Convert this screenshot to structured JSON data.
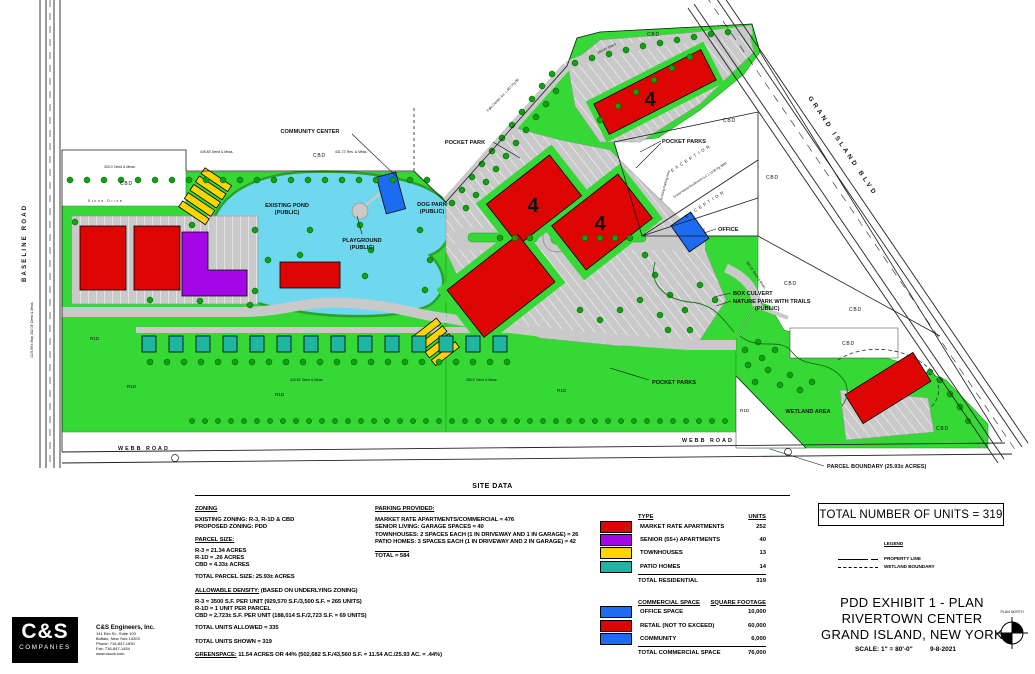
{
  "map": {
    "roads": {
      "baseline": "BASELINE ROAD",
      "webb": "WEBB ROAD",
      "grand_island": "GRAND ISLAND BLVD"
    },
    "labels": {
      "community_center": "COMMUNITY CENTER",
      "pocket_park": "POCKET PARK",
      "pocket_parks": "POCKET PARKS",
      "existing_pond_1": "EXISTING POND",
      "existing_pond_2": "(PUBLIC)",
      "playground_1": "PLAYGROUND",
      "playground_2": "(PUBLIC)",
      "dog_park_1": "DOG PARK",
      "dog_park_2": "(PUBLIC)",
      "office": "OFFICE",
      "box_culvert": "BOX CULVERT",
      "nature_park_1": "NATURE PARK WITH TRAILS",
      "nature_park_2": "(PUBLIC)",
      "wetland_area": "WETLAND AREA",
      "parcel_boundary": "PARCEL BOUNDARY (25.93± ACRES)",
      "exception": "EXCEPTION",
      "deed_note_1": "Falls Center, Inc. L 857 Pg 88",
      "deed_note_2": "Grand Island Boulevard LLC L 1159 Pg 3082",
      "existing_parking": "Existing Parking Area",
      "stone_drive": "Stone Drive",
      "story_4": "4",
      "cbd": "CBD",
      "r1d": "R1D"
    },
    "dimensions": [
      "435.83' Deed & Meas.",
      "431.72' Res. & Meas.",
      "300.0' Deed & Meas.",
      "1105.99'± Map  332.09' Deed & Meas.",
      "418.82' Deed & Meas.",
      "285.6' Deed & Meas.",
      "160.00' Deed",
      "345.11' Deed & Meas."
    ]
  },
  "site_data": {
    "title": "SITE DATA",
    "zoning_heading": "ZONING",
    "zoning_lines": [
      "EXISTING ZONING: R-3, R-1D & CBD",
      "PROPOSED ZONING: PDD"
    ],
    "parcel_heading": "PARCEL SIZE:",
    "parcel_lines": [
      "R-3 = 21.34 ACRES",
      "R-1D = .26 ACRES",
      "CBD = 4.33± ACRES"
    ],
    "total_parcel": "TOTAL PARCEL SIZE: 25.93± ACRES",
    "density_heading": "ALLOWABLE DENSITY:",
    "density_note": " (BASED ON UNDERLYING ZONING)",
    "density_lines": [
      "R-3 = 3500 S.F. PER UNIT (929,570 S.F./3,500 S.F. = 265 UNITS)",
      "R-1D = 1 UNIT PER PARCEL",
      "CBD = 2,723± S.F. PER UNIT (188,014 S.F./2,723 S.F. = 69 UNITS)"
    ],
    "total_allowed": "TOTAL UNITS ALLOWED = 335",
    "total_shown": "TOTAL UNITS SHOWN = 319",
    "greenspace_label": "GREENSPACE:",
    "greenspace_text": " 11.54 ACRES OR 44% (502,682 S.F./43,560 S.F. = 11.54 AC./25.93 AC. = .44%)"
  },
  "parking": {
    "heading": "PARKING PROVIDED:",
    "lines": [
      "MARKET RATE APARTMENTS/COMMERCIAL = 476",
      "SENIOR LIVING: GARAGE SPACES = 40",
      "TOWNHOUSES: 2 SPACES EACH (1 IN DRIVEWAY AND 1 IN GARAGE) = 26",
      "PATIO HOMES: 3 SPACES EACH (1 IN DRIVEWAY AND 2 IN GARAGE) = 42"
    ],
    "total": "TOTAL = 584"
  },
  "unit_table": {
    "col_type": "TYPE",
    "col_units": "UNITS",
    "rows": [
      {
        "label": "MARKET RATE APARTMENTS",
        "value": "252",
        "color": "#DD0404"
      },
      {
        "label": "SENIOR (55+) APARTMENTS",
        "value": "40",
        "color": "#A507E8"
      },
      {
        "label": "TOWNHOUSES",
        "value": "13",
        "color": "#FFD403"
      },
      {
        "label": "PATIO HOMES",
        "value": "14",
        "color": "#1FB5A3"
      }
    ],
    "total_label": "TOTAL RESIDENTIAL",
    "total_value": "319"
  },
  "commercial_table": {
    "col_space": "COMMERCIAL SPACE",
    "col_sqft": "SQUARE FOOTAGE",
    "rows": [
      {
        "label": "OFFICE SPACE",
        "value": "10,000",
        "color": "#1D6BF0"
      },
      {
        "label": "RETAIL (NOT TO EXCEED)",
        "value": "60,000",
        "color": "#DD0404"
      },
      {
        "label": "COMMUNITY",
        "value": "6,000",
        "color": "#1D6BF0"
      }
    ],
    "total_label": "TOTAL COMMERCIAL SPACE",
    "total_value": "76,000"
  },
  "summary_box": "TOTAL NUMBER OF UNITS = 319",
  "legend": {
    "heading": "LEGEND",
    "property_line": "PROPERTY LINE",
    "wetland_boundary": "WETLAND BOUNDARY"
  },
  "title_block": {
    "line1": "PDD EXHIBIT 1 - PLAN",
    "line2": "RIVERTOWN CENTER",
    "line3": "GRAND ISLAND, NEW YORK",
    "scale": "SCALE: 1\" = 80'-0\"",
    "date": "9-8-2021",
    "north": "PLAN NORTH"
  },
  "firm": {
    "logo_top": "C&S",
    "logo_bottom": "COMPANIES",
    "name": "C&S Engineers, Inc.",
    "address1": "141 Elm St., Suite 100",
    "address2": "Buffalo, New York 14203",
    "phone": "Phone: 716-847-1630",
    "fax": "Fax: 716-847-1454",
    "web": "www.cscos.com"
  }
}
